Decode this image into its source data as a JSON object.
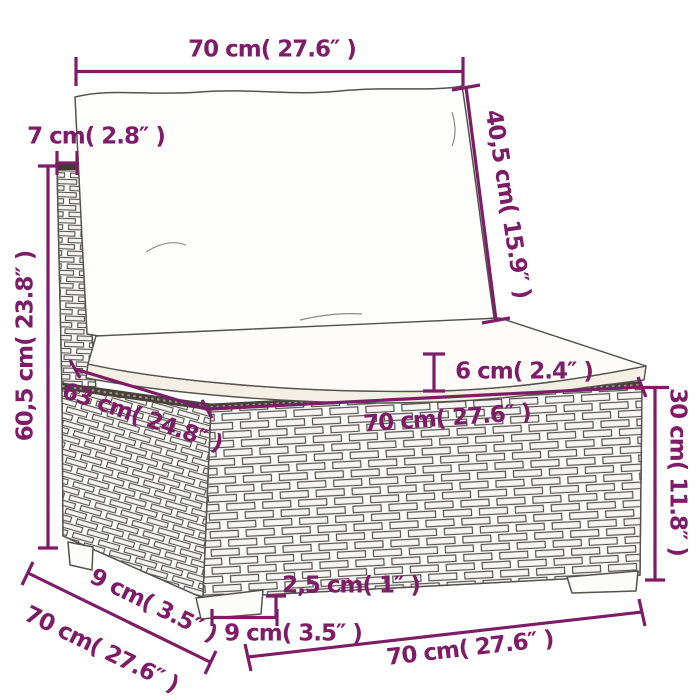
{
  "page": {
    "background": "#ffffff"
  },
  "style": {
    "accent_color": "#7e1c68",
    "outline_color": "#55524d",
    "rim_color": "#49423a"
  },
  "product": {
    "name": "poly-rattan middle sofa section with back cushion and seat cushion",
    "view": "three-quarter line drawing with dimension callouts"
  },
  "dims": {
    "back_cushion_width": {
      "label": "70 cm( 27.6″ )"
    },
    "back_panel_thickness": {
      "label": "7 cm( 2.8″ )"
    },
    "back_cushion_height": {
      "label": "40,5 cm( 15.9″ )"
    },
    "total_height": {
      "label": "60,5 cm( 23.8″ )"
    },
    "seat_cushion_thickness": {
      "label": "6 cm( 2.4″ )"
    },
    "seat_width": {
      "label": "70 cm( 27.6″ )"
    },
    "seat_depth": {
      "label": "63 cm( 24.8″ )"
    },
    "base_height": {
      "label": "30 cm( 11.8″ )"
    },
    "overhang_depth": {
      "label": "9 cm( 3.5″ )"
    },
    "total_depth": {
      "label": "70 cm( 27.6″ )"
    },
    "leg_height": {
      "label": "2,5 cm( 1″ )"
    },
    "leg_depth": {
      "label": "9 cm( 3.5″ )"
    },
    "base_width": {
      "label": "70 cm( 27.6″ )"
    }
  }
}
